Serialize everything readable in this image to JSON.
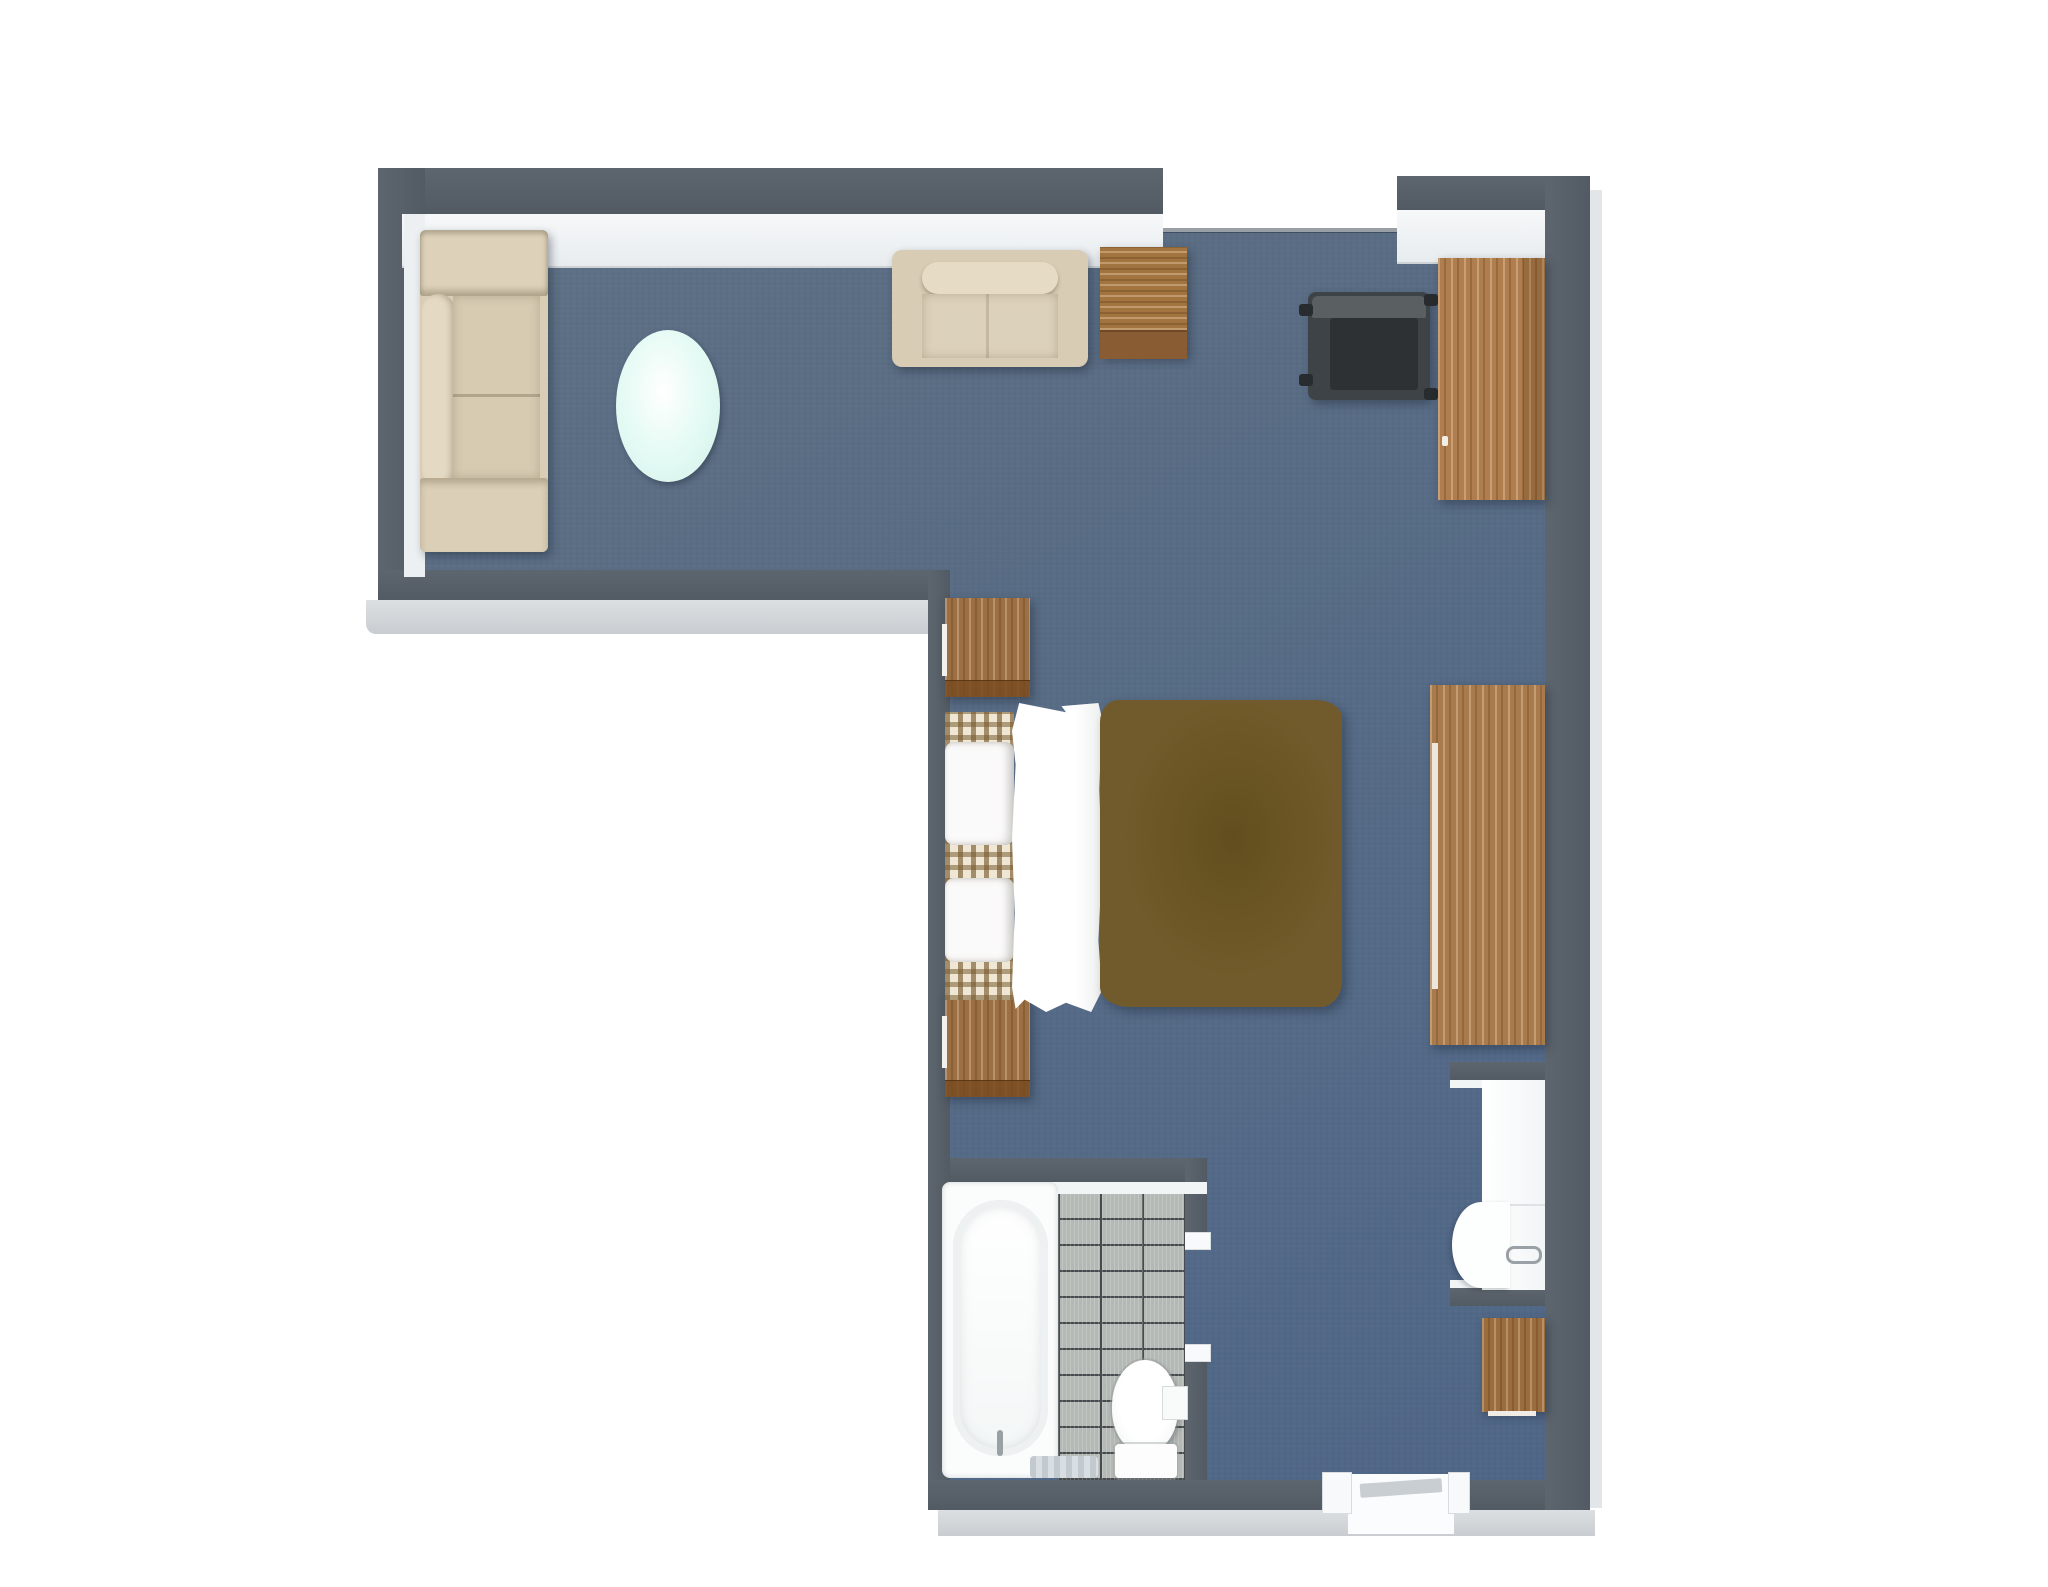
{
  "scene": {
    "type": "3d-floor-plan-top-view",
    "room_shape": "L-shaped studio hotel room",
    "visible_text": "none",
    "areas": [
      "living-area",
      "bedroom",
      "bathroom",
      "entry"
    ]
  },
  "palette": {
    "background": "#ffffff",
    "wall_top": "#57606a",
    "wall_outer_face": "#d2d6da",
    "wall_inner_lining": "#f1f4f6",
    "floor_carpet": "#566b85",
    "wood": "#a87a4c",
    "upholstery_beige": "#dcd0b8",
    "duvet_brown": "#6b5524",
    "coffee_table_mint": "#dcf7f0",
    "tile_gray": "#b5b9b5",
    "tile_grout": "#474b4d",
    "dark_chair": "#3e4347",
    "fixtures_white": "#fbfcfc"
  },
  "furniture": {
    "sofa": {
      "label": "Beige sofa",
      "area": "living-area"
    },
    "coffee_table": {
      "label": "Oval mint coffee table",
      "area": "living-area"
    },
    "armchair": {
      "label": "Beige armchair",
      "area": "living-area"
    },
    "side_table": {
      "label": "Wooden side table",
      "area": "living-area"
    },
    "lounge_chair": {
      "label": "Dark lounge chair",
      "area": "living-area"
    },
    "wardrobe": {
      "label": "Wooden wardrobe",
      "area": "living-area"
    },
    "bed": {
      "label": "Double bed with brown duvet and plaid pillows",
      "area": "bedroom"
    },
    "nightstand_top": {
      "label": "Nightstand",
      "area": "bedroom"
    },
    "nightstand_bottom": {
      "label": "Nightstand",
      "area": "bedroom"
    },
    "dresser": {
      "label": "Long wooden dresser",
      "area": "bedroom"
    },
    "bathtub": {
      "label": "Bathtub",
      "area": "bathroom"
    },
    "toilet": {
      "label": "Toilet",
      "area": "bathroom"
    },
    "tp_holder": {
      "label": "Toilet roll holder",
      "area": "bathroom"
    },
    "bath_mat": {
      "label": "Bath mat",
      "area": "bathroom"
    },
    "vanity_sink": {
      "label": "Vanity sink",
      "area": "entry"
    },
    "bath_cabinet": {
      "label": "Small wooden cabinet",
      "area": "entry"
    },
    "entry_door": {
      "label": "Entry door",
      "area": "entry"
    },
    "bathroom_door": {
      "label": "Bathroom door opening",
      "area": "bathroom"
    },
    "window_top": {
      "label": "Window sill along top wall",
      "area": "living-area"
    }
  }
}
